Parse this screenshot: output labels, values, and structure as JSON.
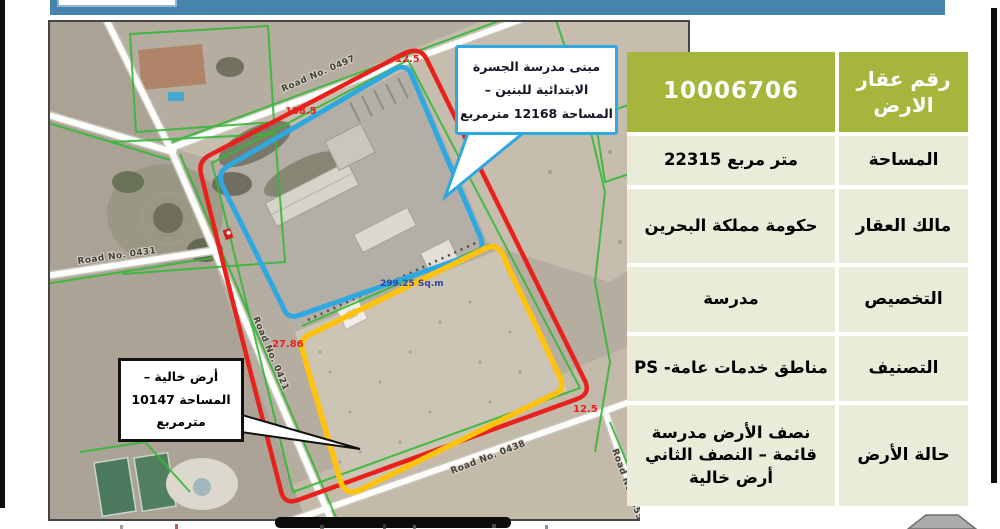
{
  "map": {
    "road_labels": {
      "r0497": "Road No. 0497",
      "r0431": "Road No. 0431",
      "r0421": "Road No. 0421",
      "r0438": "Road No. 0438",
      "r0455": "Road No 0455"
    },
    "measurements": {
      "top_edge": "108.5",
      "north_corner": "12.5",
      "east_corner": "12.5",
      "west_edge": "27.86",
      "area_note": "299.25 Sq.m"
    },
    "boundary_colors": {
      "full_plot": "#e8211d",
      "school_half": "#2fa8e0",
      "vacant_half": "#ffc20d",
      "parcel_lines": "#35b837"
    }
  },
  "callouts": {
    "school": {
      "line1": "مبنى مدرسة الجسرة",
      "line2": "الابتدائية للبنين –",
      "line3": "المساحة 12168 مترمربع"
    },
    "vacant": {
      "line1": "أرض خالية –",
      "line2": "المساحة 10147",
      "line3": "مترمربع"
    }
  },
  "table": {
    "header": {
      "label": "رقم عقار الارض",
      "value": "10006706"
    },
    "rows": [
      {
        "label": "المساحة",
        "value": "22315 متر مربع"
      },
      {
        "label": "مالك العقار",
        "value": "حكومة مملكة البحرين"
      },
      {
        "label": "التخصيص",
        "value": "مدرسة"
      },
      {
        "label": "التصنيف",
        "value": "مناطق خدمات عامة- PS"
      },
      {
        "label": "حالة الأرض",
        "value": "نصف الأرض مدرسة قائمة – النصف الثاني أرض خالية"
      }
    ],
    "header_bg": "#a6b53b",
    "cell_bg": "#e9ecd8"
  }
}
